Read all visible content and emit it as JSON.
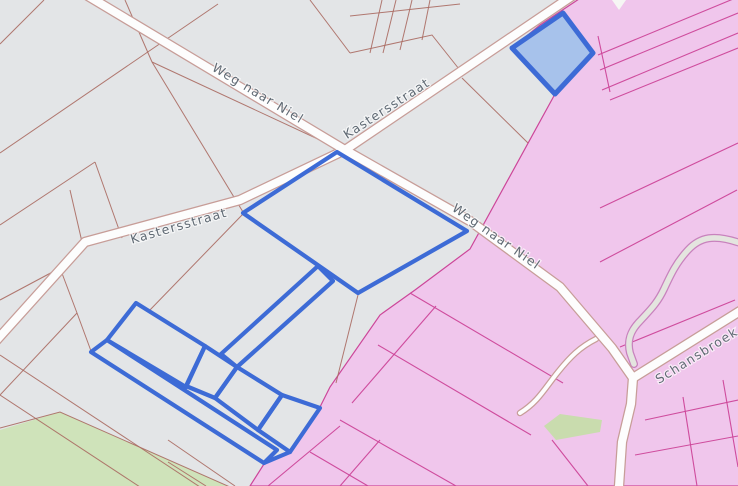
{
  "map": {
    "street_labels": [
      {
        "id": "weg-naar-niel-nw",
        "text": "Weg naar Niel"
      },
      {
        "id": "kastersstraat-ne",
        "text": "Kastersstraat"
      },
      {
        "id": "kastersstraat-w",
        "text": "Kastersstraat"
      },
      {
        "id": "weg-naar-niel-se",
        "text": "Weg naar Niel"
      },
      {
        "id": "schansbroek",
        "text": "Schansbroek"
      }
    ],
    "colors": {
      "parcel_background": "#e3e5e7",
      "parcel_line": "#aa6a62",
      "zoned_area_fill": "#f0c6ec",
      "zoned_area_line": "#cc4699",
      "selection_stroke": "#3d6bd6",
      "selection_fill": "#a7c2eb",
      "road_fill": "#fdfdfd",
      "road_casing": "#c79d98",
      "vegetation_fill": "#cfe3ba",
      "stream_fill": "#e4e5df",
      "label_color": "#606a74"
    }
  }
}
